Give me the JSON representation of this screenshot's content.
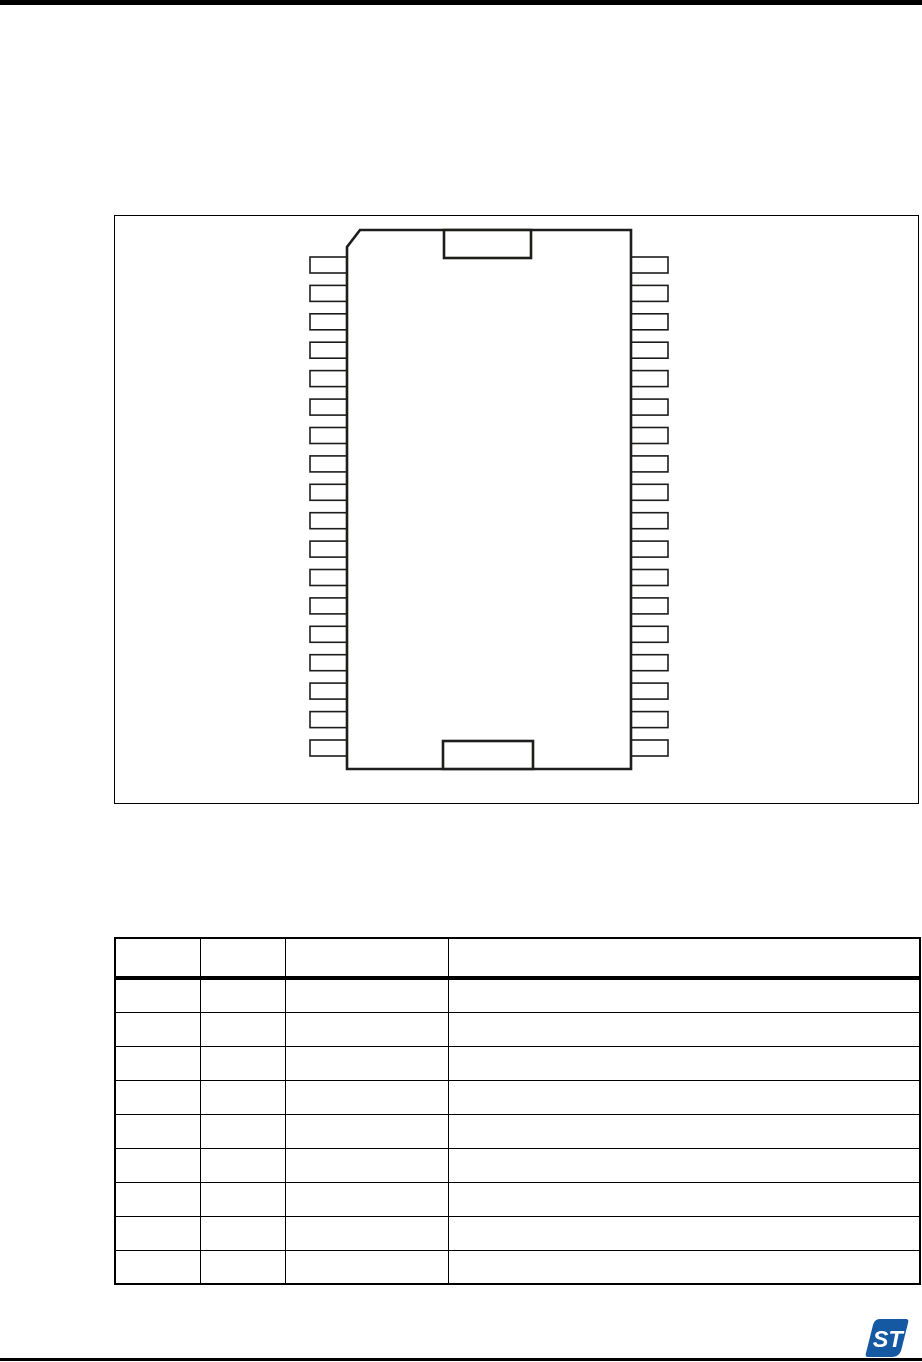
{
  "page": {
    "background": "#ffffff",
    "rule_color": "#000000"
  },
  "figure": {
    "kind": "ic-package-pinout-outline",
    "pins_per_side": 18,
    "pin_sides": [
      "left",
      "right"
    ],
    "index_notches": [
      "top-center",
      "bottom-center"
    ],
    "corner_chamfer": "top-left",
    "line_color": "#1d1d1b",
    "fill_color": "#ffffff"
  },
  "pin_table": {
    "column_count": 4,
    "data_row_count": 9,
    "header_labels": [
      "",
      "",
      "",
      ""
    ],
    "cells_empty": true,
    "line_color": "#000000"
  },
  "footer": {
    "logo": {
      "name": "st-logo",
      "text": "ST",
      "color": "#1559a2",
      "text_color": "#ffffff"
    }
  }
}
